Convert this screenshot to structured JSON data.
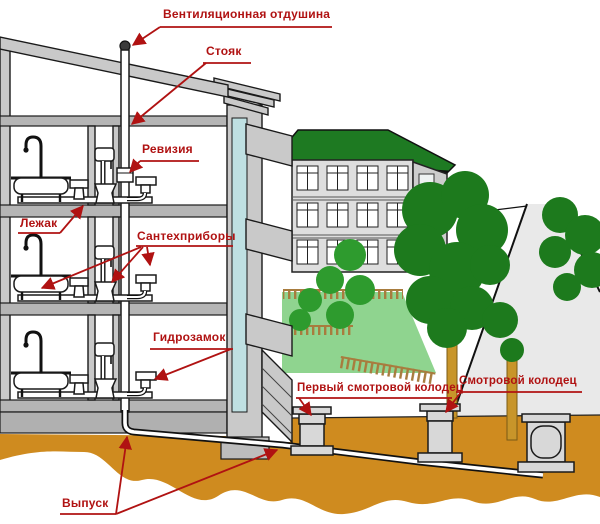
{
  "colors": {
    "label": "#b01212",
    "ground": "#cf8b1f",
    "roof": "#1e7a22",
    "wall": "#c9c9c9",
    "slab": "#b5b5b5",
    "teal": "#bfe0e2",
    "lawn": "#8fd48f",
    "tree_dark": "#1d7a1d",
    "tree_mid": "#2e9b2e",
    "trunk": "#c8952a",
    "fence": "#a87c3e",
    "road": "#e9e9e9"
  },
  "labels": {
    "vent": {
      "text": "Вентиляционная отдушина"
    },
    "riser": {
      "text": "Стояк"
    },
    "revision": {
      "text": "Ревизия"
    },
    "bed_pipe": {
      "text": "Лежак"
    },
    "fixtures": {
      "text": "Сантехприборы"
    },
    "water_seal": {
      "text": "Гидрозамок"
    },
    "first_inspection_well": {
      "text": "Первый смотровой колодец"
    },
    "inspection_well": {
      "text": "Смотровой колодец"
    },
    "outlet": {
      "text": "Выпуск"
    }
  }
}
